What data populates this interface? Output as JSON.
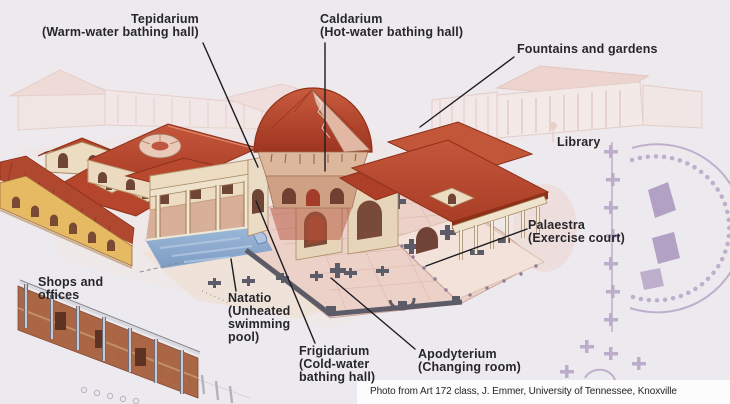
{
  "labels": {
    "tepidarium": {
      "name": "Tepidarium",
      "sub": "(Warm-water bathing hall)"
    },
    "caldarium": {
      "name": "Caldarium",
      "sub": "(Hot-water bathing hall)"
    },
    "fountains": {
      "name": "Fountains and gardens"
    },
    "library": {
      "name": "Library"
    },
    "palaestra": {
      "name": "Palaestra",
      "sub": "(Exercise court)"
    },
    "shops": {
      "name": "Shops and\noffices"
    },
    "natatio": {
      "name": "Natatio",
      "sub": "(Unheated\nswimming\npool)"
    },
    "frigidarium": {
      "name": "Frigidarium",
      "sub": "(Cold-water\nbathing hall)"
    },
    "apodyterium": {
      "name": "Apodyterium",
      "sub": "(Changing room)"
    }
  },
  "credit": "Photo from Art 172 class, J. Emmer, University of Tennessee, Knoxville",
  "colors": {
    "paper": "#edeaef",
    "label_text": "#26262b",
    "leader_line": "#1c1c20",
    "roof_red": "#b5452c",
    "roof_dark": "#8e3018",
    "wall_cream": "#ebdabf",
    "facade_yellow": "#e6ba62",
    "pool_blue": "#8aa7cc",
    "plan_pink": "#ecd1c9",
    "plan_wall_gray": "#5c5b68",
    "faint_pink": "#f2d9d2",
    "faint_purple": "#b3a2c5",
    "credit_bg": "#fcfcfd"
  }
}
